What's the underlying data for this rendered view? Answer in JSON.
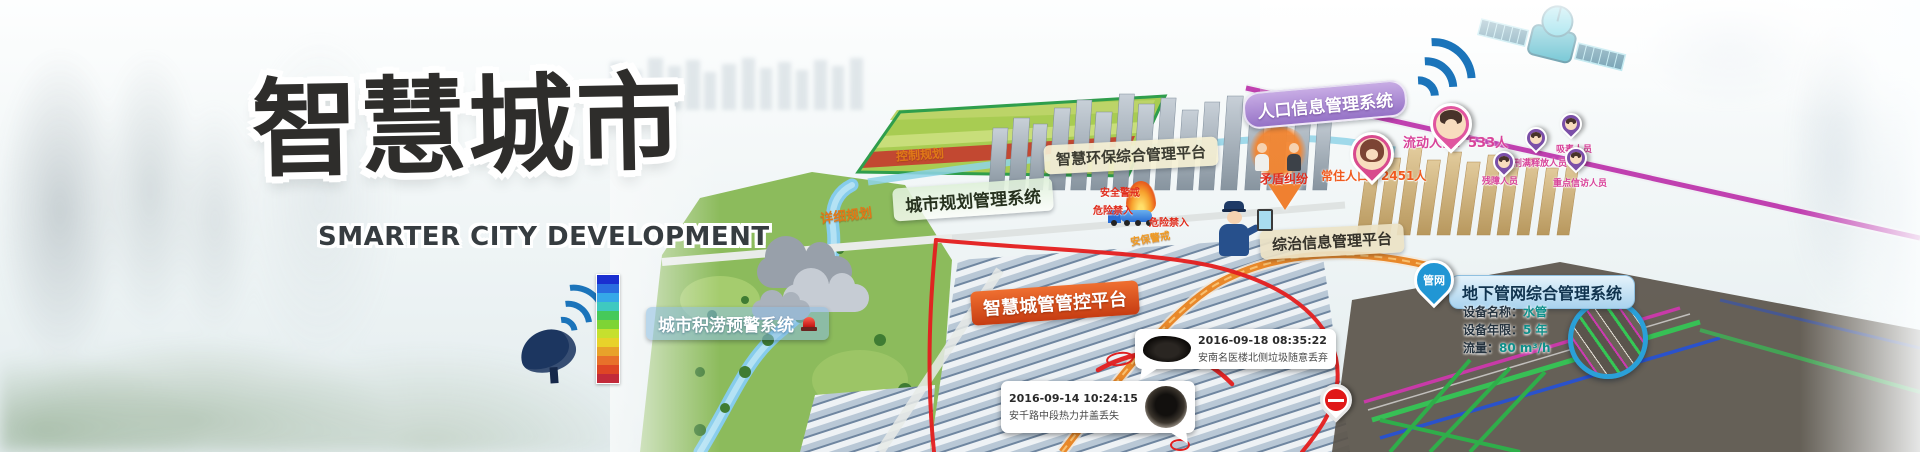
{
  "banner": {
    "title": "智慧城市",
    "subtitle": "SMARTER CITY DEVELOPMENT"
  },
  "system_labels": {
    "population": "人口信息管理系统",
    "environment": "智慧环保综合管理平台",
    "planning": "城市规划管理系统",
    "governance": "综治信息管理平台",
    "city_mgmt": "智慧城管管控平台",
    "pipe_network": "地下管网综合管理系统",
    "flood": "城市积涝预警系统"
  },
  "map_labels": {
    "control_plan": "控制规划",
    "detail_plan": "详细规划",
    "security_guard": "安保警戒",
    "safety_cordon": "安全警戒",
    "danger_no_entry_1": "危险禁入",
    "danger_no_entry_2": "危险禁入",
    "dispute": "矛盾纠纷"
  },
  "population_stats": {
    "resident": "常住人口：2451人",
    "migrant": "流动人口：533人"
  },
  "person_tags": {
    "disabled": "残障人员",
    "released": "刑满释放人员",
    "drug": "吸毒人员",
    "petition": "重点信访人员"
  },
  "pipe_pin": "管网",
  "pipe_info": {
    "name_label": "设备名称：",
    "name_value": "水管",
    "age_label": "设备年限：",
    "age_value": "5 年",
    "flow_label": "流量：",
    "flow_value": "80 m³/h"
  },
  "incidents": {
    "garbage": {
      "time": "2016-09-18 08:35:22",
      "desc": "安南名医楼北侧垃圾随意丢弃"
    },
    "manhole": {
      "time": "2016-09-14 10:24:15",
      "desc": "安千路中段热力井盖丢失"
    }
  },
  "legend": {
    "colors": [
      "#1a2fd0",
      "#2a6de0",
      "#35a8e8",
      "#3fc9c0",
      "#46c95a",
      "#7ed435",
      "#c6e02e",
      "#e8d22a",
      "#e8a22a",
      "#e8712a",
      "#de4525",
      "#c22a3a"
    ]
  },
  "colors": {
    "accent_red": "#e41e1e",
    "label_purple": "#9572c6",
    "label_orange_red": "#c63c12",
    "label_blue": "#a9d3ee",
    "pin_pink": "#e0559f",
    "pin_purple": "#7b4fa8",
    "pin_blue": "#2196d4"
  }
}
